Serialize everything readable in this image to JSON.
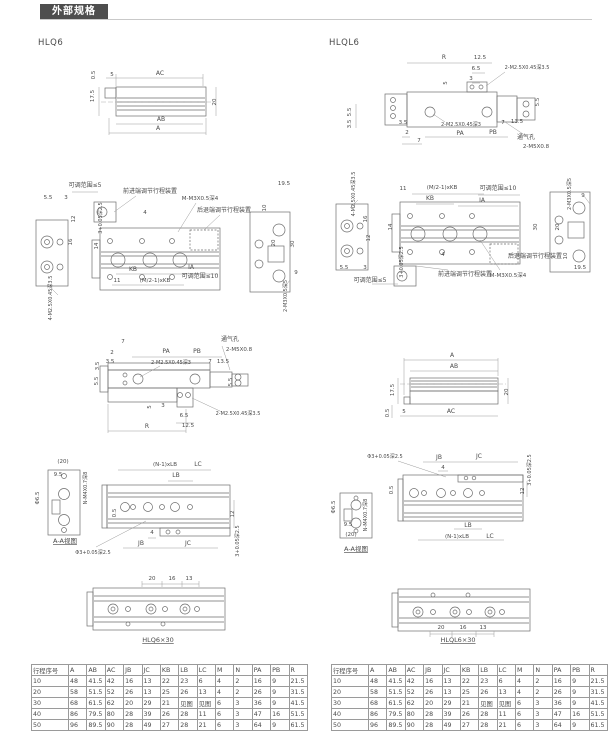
{
  "header": {
    "title": "外部规格"
  },
  "models": {
    "left": "HLQ6",
    "right": "HLQL6"
  },
  "drawings": {
    "l1": {
      "labels": [
        {
          "t": "AC",
          "x": 90,
          "y": 13
        },
        {
          "t": "5",
          "x": 42,
          "y": 14,
          "s": 5.5
        },
        {
          "t": "0.5",
          "x": 25,
          "y": 13,
          "r": -90,
          "s": 5.5
        },
        {
          "t": "17.5",
          "x": 24,
          "y": 34,
          "r": -90,
          "s": 5.5
        },
        {
          "t": "20",
          "x": 146,
          "y": 40,
          "r": -90,
          "s": 5.5
        },
        {
          "t": "AB",
          "x": 91,
          "y": 59
        },
        {
          "t": "A",
          "x": 88,
          "y": 68
        }
      ]
    },
    "l2": {
      "labels": [
        {
          "t": "可调范围≤5",
          "x": 57,
          "y": 17,
          "s": 6
        },
        {
          "t": "5.5",
          "x": 20,
          "y": 29,
          "s": 5.5
        },
        {
          "t": "3",
          "x": 38,
          "y": 29,
          "s": 5.5
        },
        {
          "t": "前进端调节行程装置",
          "x": 122,
          "y": 23,
          "s": 6
        },
        {
          "t": "M-M3X0.5深4",
          "x": 172,
          "y": 30,
          "s": 5.5
        },
        {
          "t": "后退端调节行程装置",
          "x": 196,
          "y": 42,
          "s": 6
        },
        {
          "t": "19.5",
          "x": 256,
          "y": 15,
          "s": 5.5
        },
        {
          "t": "10",
          "x": 238,
          "y": 38,
          "r": -90,
          "s": 5.5
        },
        {
          "t": "4",
          "x": 117,
          "y": 44,
          "s": 5.5
        },
        {
          "t": "3+0.05深2.5",
          "x": 74,
          "y": 48,
          "r": -90,
          "s": 5
        },
        {
          "t": "12",
          "x": 47,
          "y": 49,
          "r": -90,
          "s": 5.5
        },
        {
          "t": "16",
          "x": 44,
          "y": 72,
          "r": -90,
          "s": 5.5
        },
        {
          "t": "14",
          "x": 70,
          "y": 76,
          "r": -90,
          "s": 5.5
        },
        {
          "t": "30",
          "x": 266,
          "y": 74,
          "r": -90,
          "s": 5.5
        },
        {
          "t": "20",
          "x": 247,
          "y": 73,
          "r": -90,
          "s": 5.5
        },
        {
          "t": "KB",
          "x": 105,
          "y": 101
        },
        {
          "t": "IA",
          "x": 163,
          "y": 99
        },
        {
          "t": "可调范围≤10",
          "x": 172,
          "y": 108,
          "s": 6
        },
        {
          "t": "11",
          "x": 89,
          "y": 112,
          "s": 5.5
        },
        {
          "t": "(M/2-1)xKB",
          "x": 127,
          "y": 112,
          "s": 5.5
        },
        {
          "t": "4-M2.5X0.45深3.5",
          "x": 24,
          "y": 128,
          "r": -90,
          "s": 5
        },
        {
          "t": "2-M3X0.5深5",
          "x": 259,
          "y": 126,
          "r": -90,
          "s": 5
        },
        {
          "t": "9",
          "x": 268,
          "y": 104,
          "s": 5.5
        }
      ]
    },
    "l3": {
      "labels": [
        {
          "t": "7",
          "x": 51,
          "y": 13,
          "s": 5.5
        },
        {
          "t": "2",
          "x": 40,
          "y": 24,
          "s": 5.5
        },
        {
          "t": "PA",
          "x": 94,
          "y": 23
        },
        {
          "t": "PB",
          "x": 125,
          "y": 23
        },
        {
          "t": "通气孔",
          "x": 158,
          "y": 11,
          "s": 6
        },
        {
          "t": "2-M5X0.8",
          "x": 167,
          "y": 21,
          "s": 5.5
        },
        {
          "t": "3.5",
          "x": 38,
          "y": 33,
          "s": 5.5
        },
        {
          "t": "2-M2.5X0.45深3",
          "x": 99,
          "y": 34,
          "s": 5
        },
        {
          "t": "7",
          "x": 138,
          "y": 33,
          "s": 5.5
        },
        {
          "t": "13.5",
          "x": 151,
          "y": 33,
          "s": 5.5
        },
        {
          "t": "3.5",
          "x": 27,
          "y": 36,
          "r": -90,
          "s": 5.5
        },
        {
          "t": "5.5",
          "x": 26,
          "y": 51,
          "r": -90,
          "s": 5.5
        },
        {
          "t": "5.5",
          "x": 160,
          "y": 52,
          "r": -90,
          "s": 5.5
        },
        {
          "t": "5",
          "x": 79,
          "y": 77,
          "r": -90,
          "s": 5.5
        },
        {
          "t": "3",
          "x": 91,
          "y": 77,
          "s": 5.5
        },
        {
          "t": "6.5",
          "x": 112,
          "y": 87,
          "s": 5.5
        },
        {
          "t": "12.5",
          "x": 116,
          "y": 97,
          "s": 5.5
        },
        {
          "t": "R",
          "x": 75,
          "y": 98
        },
        {
          "t": "2-M2.5X0.45深3.5",
          "x": 166,
          "y": 85,
          "s": 5
        }
      ]
    },
    "l4": {
      "labels": [
        {
          "t": "(20)",
          "x": 35,
          "y": 17,
          "s": 5.5
        },
        {
          "t": "9.5",
          "x": 30,
          "y": 30,
          "s": 5.5
        },
        {
          "t": "Φ6.5",
          "x": 11,
          "y": 52,
          "r": -90,
          "s": 5.5
        },
        {
          "t": "N-M4X0.7深8",
          "x": 59,
          "y": 42,
          "r": -90,
          "s": 5
        },
        {
          "t": "A-A视图",
          "x": 37,
          "y": 97,
          "u": 1,
          "s": 6.5
        },
        {
          "t": "(N-1)xLB",
          "x": 137,
          "y": 20,
          "s": 5.5
        },
        {
          "t": "LC",
          "x": 170,
          "y": 20
        },
        {
          "t": "LB",
          "x": 148,
          "y": 31
        },
        {
          "t": "0.5",
          "x": 88,
          "y": 67,
          "r": -90,
          "s": 5.5
        },
        {
          "t": "12",
          "x": 206,
          "y": 68,
          "r": -90,
          "s": 5.5
        },
        {
          "t": "4",
          "x": 124,
          "y": 88,
          "s": 5.5
        },
        {
          "t": "JB",
          "x": 113,
          "y": 99
        },
        {
          "t": "JC",
          "x": 160,
          "y": 99
        },
        {
          "t": "Φ3+0.05深2.5",
          "x": 65,
          "y": 108,
          "s": 5
        },
        {
          "t": "3+0.05深2.5",
          "x": 211,
          "y": 95,
          "r": -90,
          "s": 5
        }
      ]
    },
    "l5": {
      "labels": [
        {
          "t": "20",
          "x": 67,
          "y": 12,
          "s": 5.5
        },
        {
          "t": "16",
          "x": 87,
          "y": 12,
          "s": 5.5
        },
        {
          "t": "13",
          "x": 104,
          "y": 12,
          "s": 5.5
        },
        {
          "t": "HLQ6×30",
          "x": 73,
          "y": 74,
          "u": 1,
          "s": 6.5
        }
      ]
    },
    "r1": {
      "labels": [
        {
          "t": "R",
          "x": 104,
          "y": 17
        },
        {
          "t": "12.5",
          "x": 140,
          "y": 17,
          "s": 5.5
        },
        {
          "t": "6.5",
          "x": 136,
          "y": 28,
          "s": 5.5
        },
        {
          "t": "3",
          "x": 131,
          "y": 38,
          "s": 5.5
        },
        {
          "t": "2-M2.5X0.45深3.5",
          "x": 187,
          "y": 27,
          "s": 5
        },
        {
          "t": "5",
          "x": 107,
          "y": 41,
          "r": -90,
          "s": 5.5
        },
        {
          "t": "5.5",
          "x": 11,
          "y": 70,
          "r": -90,
          "s": 5.5
        },
        {
          "t": "3.5",
          "x": 11,
          "y": 82,
          "r": -90,
          "s": 5.5
        },
        {
          "t": "3.5",
          "x": 63,
          "y": 82,
          "s": 5.5
        },
        {
          "t": "2",
          "x": 67,
          "y": 92,
          "s": 5.5
        },
        {
          "t": "7",
          "x": 79,
          "y": 100,
          "s": 5.5
        },
        {
          "t": "2-M2.5X0.45深3",
          "x": 121,
          "y": 84,
          "s": 5
        },
        {
          "t": "PA",
          "x": 120,
          "y": 93
        },
        {
          "t": "PB",
          "x": 153,
          "y": 92
        },
        {
          "t": "7",
          "x": 163,
          "y": 82,
          "s": 5.5
        },
        {
          "t": "13.5",
          "x": 177,
          "y": 81,
          "s": 5.5
        },
        {
          "t": "通气孔",
          "x": 186,
          "y": 97,
          "s": 6
        },
        {
          "t": "2-M5X0.8",
          "x": 196,
          "y": 106,
          "s": 5.5
        },
        {
          "t": "5.5",
          "x": 199,
          "y": 60,
          "r": -90,
          "s": 5.5
        }
      ]
    },
    "r2": {
      "labels": [
        {
          "t": "4-M2.5X0.45深3.5",
          "x": 27,
          "y": 24,
          "r": -90,
          "s": 5
        },
        {
          "t": "11",
          "x": 75,
          "y": 20,
          "s": 5.5
        },
        {
          "t": "(M/2-1)xKB",
          "x": 114,
          "y": 19,
          "s": 5.5
        },
        {
          "t": "KB",
          "x": 102,
          "y": 30
        },
        {
          "t": "可调范围≤10",
          "x": 170,
          "y": 20,
          "s": 6
        },
        {
          "t": "IA",
          "x": 154,
          "y": 32
        },
        {
          "t": "2-M3X0.5深5",
          "x": 243,
          "y": 24,
          "r": -90,
          "s": 5
        },
        {
          "t": "9",
          "x": 255,
          "y": 27,
          "s": 5.5
        },
        {
          "t": "16",
          "x": 39,
          "y": 49,
          "r": -90,
          "s": 5.5
        },
        {
          "t": "12",
          "x": 42,
          "y": 68,
          "r": -90,
          "s": 5.5
        },
        {
          "t": "14",
          "x": 64,
          "y": 57,
          "r": -90,
          "s": 5.5
        },
        {
          "t": "30",
          "x": 209,
          "y": 57,
          "r": -90,
          "s": 5.5
        },
        {
          "t": "20",
          "x": 231,
          "y": 57,
          "r": -90,
          "s": 5.5
        },
        {
          "t": "3+0.05深2.5",
          "x": 75,
          "y": 92,
          "r": -90,
          "s": 5
        },
        {
          "t": "4",
          "x": 115,
          "y": 86,
          "s": 5.5
        },
        {
          "t": "10",
          "x": 239,
          "y": 86,
          "r": -90,
          "s": 5.5
        },
        {
          "t": "5.5",
          "x": 16,
          "y": 99,
          "s": 5.5
        },
        {
          "t": "3",
          "x": 37,
          "y": 99,
          "s": 5.5
        },
        {
          "t": "前进端调节行程装置",
          "x": 137,
          "y": 106,
          "s": 6
        },
        {
          "t": "M-M3X0.5深4",
          "x": 180,
          "y": 107,
          "s": 5.5
        },
        {
          "t": "后退端调节行程装置",
          "x": 207,
          "y": 88,
          "s": 6
        },
        {
          "t": "可调范围≤5",
          "x": 42,
          "y": 112,
          "s": 6
        },
        {
          "t": "19.5",
          "x": 252,
          "y": 99,
          "s": 5.5
        }
      ]
    },
    "r3": {
      "labels": [
        {
          "t": "A",
          "x": 80,
          "y": 22
        },
        {
          "t": "AB",
          "x": 82,
          "y": 33
        },
        {
          "t": "17.5",
          "x": 22,
          "y": 55,
          "r": -90,
          "s": 5.5
        },
        {
          "t": "20",
          "x": 136,
          "y": 57,
          "r": -90,
          "s": 5.5
        },
        {
          "t": "0.5",
          "x": 17,
          "y": 78,
          "r": -90,
          "s": 5.5
        },
        {
          "t": "5",
          "x": 32,
          "y": 78,
          "s": 5.5
        },
        {
          "t": "AC",
          "x": 79,
          "y": 78
        }
      ]
    },
    "r4": {
      "labels": [
        {
          "t": "Φ3+0.05深2.5",
          "x": 57,
          "y": 15,
          "s": 5
        },
        {
          "t": "JB",
          "x": 111,
          "y": 16
        },
        {
          "t": "JC",
          "x": 151,
          "y": 15
        },
        {
          "t": "4",
          "x": 115,
          "y": 26,
          "s": 5.5
        },
        {
          "t": "3+0.05深2.5",
          "x": 203,
          "y": 27,
          "r": -90,
          "s": 5
        },
        {
          "t": "12",
          "x": 196,
          "y": 48,
          "r": -90,
          "s": 5.5
        },
        {
          "t": "0.5",
          "x": 65,
          "y": 47,
          "r": -90,
          "s": 5.5
        },
        {
          "t": "Φ6.5",
          "x": 7,
          "y": 64,
          "r": -90,
          "s": 5.5
        },
        {
          "t": "N-M4X0.7深8",
          "x": 39,
          "y": 72,
          "r": -90,
          "s": 5
        },
        {
          "t": "9.5",
          "x": 20,
          "y": 83,
          "s": 5.5
        },
        {
          "t": "(20)",
          "x": 23,
          "y": 93,
          "s": 5.5
        },
        {
          "t": "A-A视图",
          "x": 28,
          "y": 108,
          "u": 1,
          "s": 6.5
        },
        {
          "t": "LB",
          "x": 140,
          "y": 84
        },
        {
          "t": "(N-1)xLB",
          "x": 129,
          "y": 95,
          "s": 5.5
        },
        {
          "t": "LC",
          "x": 162,
          "y": 95
        }
      ]
    },
    "r5": {
      "labels": [
        {
          "t": "20",
          "x": 53,
          "y": 64,
          "s": 5.5
        },
        {
          "t": "16",
          "x": 75,
          "y": 64,
          "s": 5.5
        },
        {
          "t": "13",
          "x": 95,
          "y": 64,
          "s": 5.5
        },
        {
          "t": "HLQL6×30",
          "x": 70,
          "y": 77,
          "u": 1,
          "s": 6.5
        }
      ]
    }
  },
  "table": {
    "headers": [
      "行程序号",
      "A",
      "AB",
      "AC",
      "JB",
      "JC",
      "KB",
      "LB",
      "LC",
      "M",
      "N",
      "PA",
      "PB",
      "R"
    ],
    "rows": [
      [
        "10",
        "48",
        "41.5",
        "42",
        "16",
        "13",
        "22",
        "23",
        "6",
        "4",
        "2",
        "16",
        "9",
        "21.5"
      ],
      [
        "20",
        "58",
        "51.5",
        "52",
        "26",
        "13",
        "25",
        "26",
        "13",
        "4",
        "2",
        "26",
        "9",
        "31.5"
      ],
      [
        "30",
        "68",
        "61.5",
        "62",
        "20",
        "29",
        "21",
        "见图",
        "见图",
        "6",
        "3",
        "36",
        "9",
        "41.5"
      ],
      [
        "40",
        "86",
        "79.5",
        "80",
        "28",
        "39",
        "26",
        "28",
        "11",
        "6",
        "3",
        "47",
        "16",
        "51.5"
      ],
      [
        "50",
        "96",
        "89.5",
        "90",
        "28",
        "49",
        "27",
        "28",
        "21",
        "6",
        "3",
        "64",
        "9",
        "61.5"
      ]
    ]
  },
  "colors": {
    "accent": "#4e4e4e",
    "line": "#6e6e6e",
    "dim": "#9a9a9a",
    "text": "#4a4a4a"
  }
}
